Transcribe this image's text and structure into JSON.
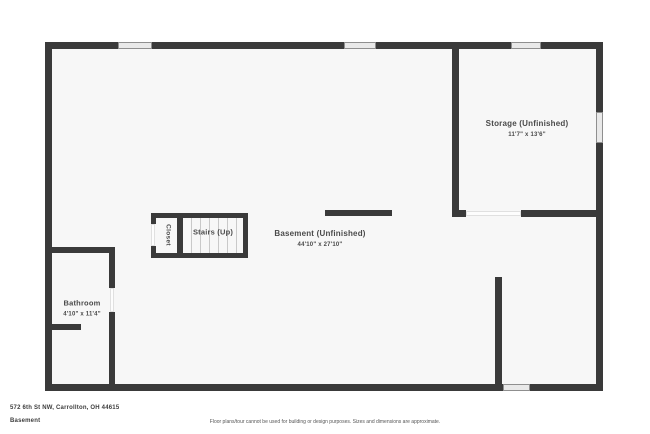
{
  "colors": {
    "wall": "#3a3a3a",
    "floor": "#f7f7f7",
    "window_fill": "#e9e9e9",
    "label_text": "#4a4a4a"
  },
  "rooms": {
    "storage": {
      "name": "Storage (Unfinished)",
      "dims": "11'7\" x 13'6\""
    },
    "basement": {
      "name": "Basement (Unfinished)",
      "dims": "44'10\" x 27'10\""
    },
    "stairs": {
      "name": "Stairs (Up)"
    },
    "closet": {
      "name": "Closet"
    },
    "bathroom": {
      "name": "Bathroom",
      "dims": "4'10\" x 11'4\""
    }
  },
  "footer": {
    "address": "572 6th St NW, Carrollton, OH 44615",
    "floor_label": "Basement",
    "disclaimer": "Floor plans/tour cannot be used for building or design purposes. Sizes and dimensions are approximate."
  }
}
